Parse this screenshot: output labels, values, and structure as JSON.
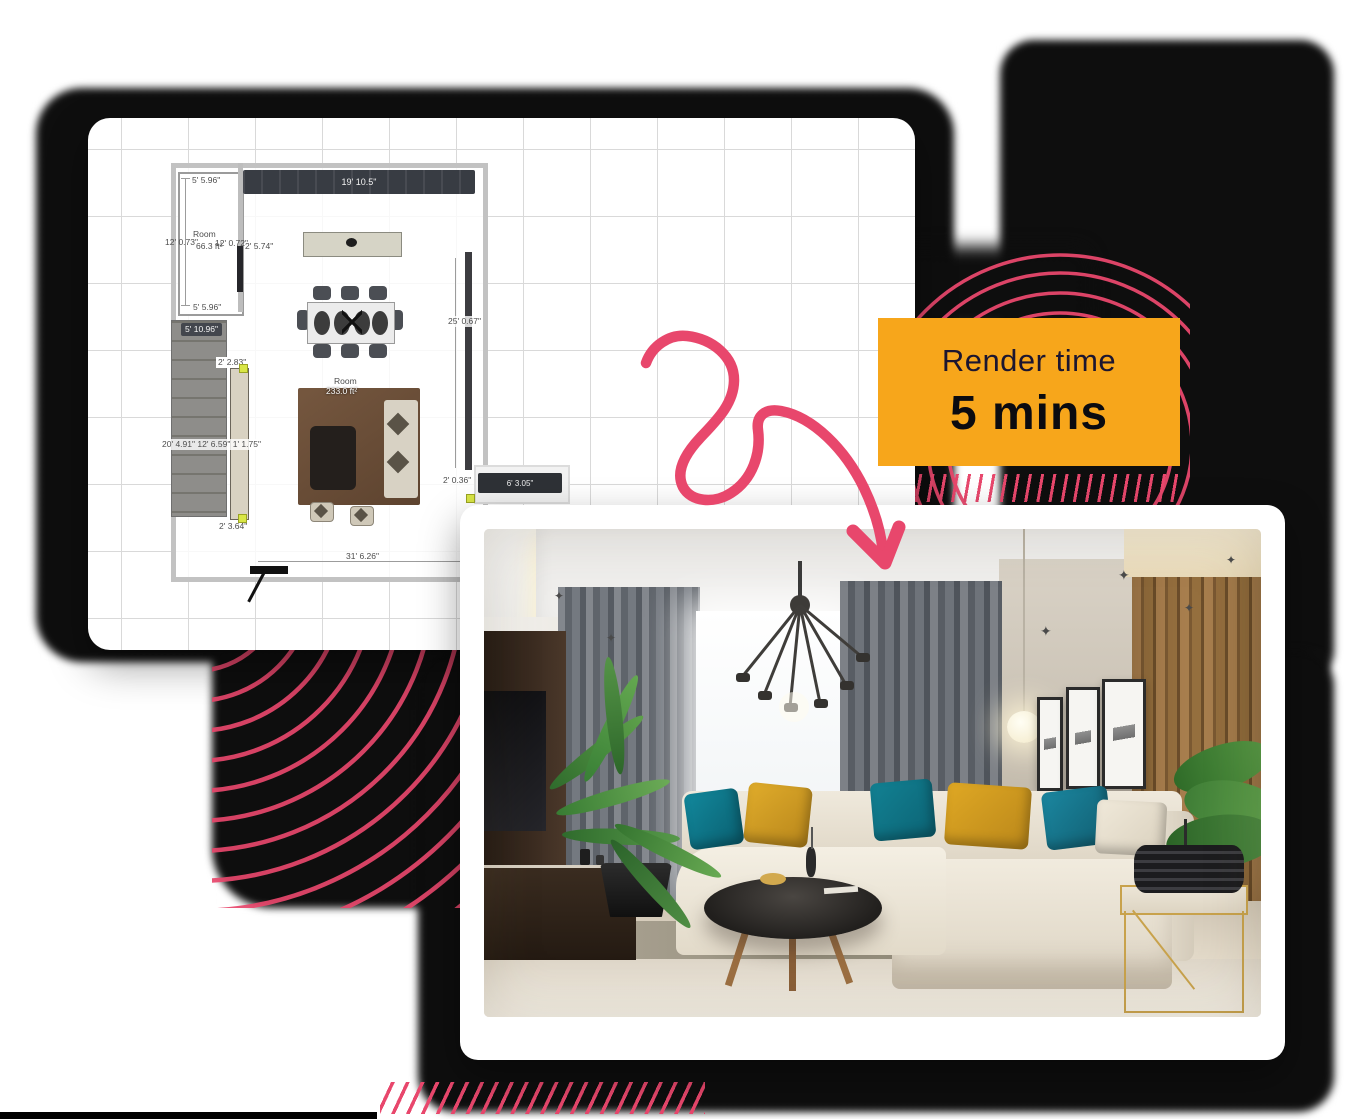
{
  "badge": {
    "line1": "Render time",
    "line2": "5 mins",
    "bg_color": "#F7A61B",
    "text_color": "#0B0B10"
  },
  "floorplan": {
    "labels": {
      "closet_top": "19' 10.5\"",
      "left_top": "5' 5.96\"",
      "left_bottom": "5' 5.96\"",
      "room_small_name": "Room",
      "room_small_area": "66.3 ft²",
      "dim_12a": "12' 0.73\"",
      "dim_12b": "12' 0.72\"",
      "dim_2_574": "2' 5.74\"",
      "stairs_width": "5' 10.96\"",
      "dim_2_283": "2' 2.83\"",
      "right_wall": "25' 0.67\"",
      "room_main_name": "Room",
      "room_main_area": "233.0 ft²",
      "left_composite": "20' 4.91\" 12' 6.59\" 1' 1.75\"",
      "dim_2_364": "2' 3.64\"",
      "dim_2_036": "2' 0.36\"",
      "console_width": "6' 3.05\"",
      "bottom_width": "31' 6.26\""
    }
  },
  "decor": {
    "arrow_color": "#E8476C",
    "arc_color": "#E8476C",
    "blob_color": "#0B0B0B"
  }
}
